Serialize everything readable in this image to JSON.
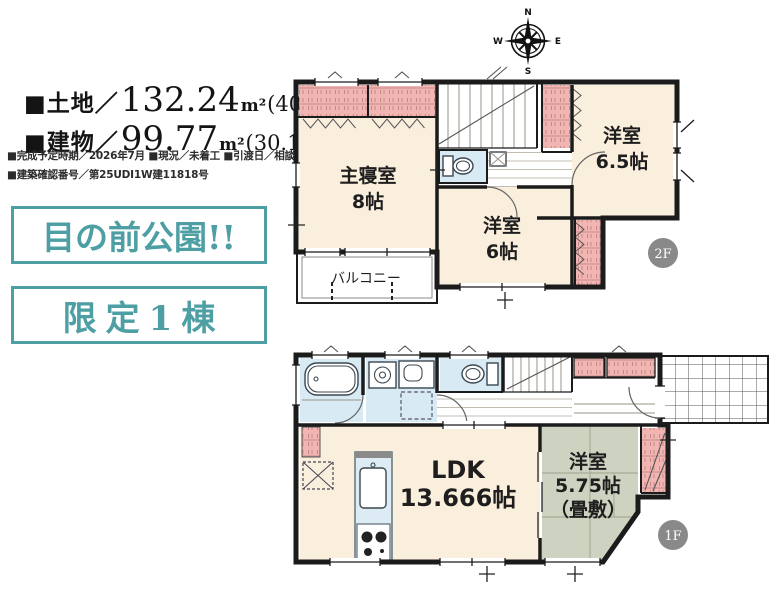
{
  "colors": {
    "teal_accent": "#4d9fa4",
    "wall": "#1b1b1b",
    "room_cream": "#faeedd",
    "closet_pink": "#f2b5b2",
    "wet_area_blue": "#d8eaf3",
    "tatami_green": "#cdd2c1",
    "floor_badge_gray": "#898989"
  },
  "specs": {
    "land_prefix": "■土地／",
    "land_value": "132.24",
    "land_unit": "m²",
    "land_tsubo": "(40.00坪)",
    "building_prefix": "■建物／",
    "building_value": "99.77",
    "building_unit": "m²",
    "building_tsubo": "(30.18坪)",
    "detail_line1": "■完成予定時期／2026年7月 ■現況／未着工 ■引渡日／相談",
    "detail_line2": "■建築確認番号／第25UDI1W建11818号"
  },
  "badges": {
    "badge1": "目の前公園!!",
    "badge2": "限定1棟"
  },
  "compass": {
    "north": "N",
    "south": "S",
    "east": "E",
    "west": "W"
  },
  "floor2": {
    "badge": "2F",
    "master_bedroom_name": "主寝室",
    "master_bedroom_size": "8帖",
    "west_room_65_name": "洋室",
    "west_room_65_size": "6.5帖",
    "west_room_6_name": "洋室",
    "west_room_6_size": "6帖",
    "balcony": "バルコニー"
  },
  "floor1": {
    "badge": "1F",
    "ldk_name": "LDK",
    "ldk_size": "13.666帖",
    "tatami_name": "洋室",
    "tatami_size": "5.75帖",
    "tatami_note": "（畳敷）"
  }
}
